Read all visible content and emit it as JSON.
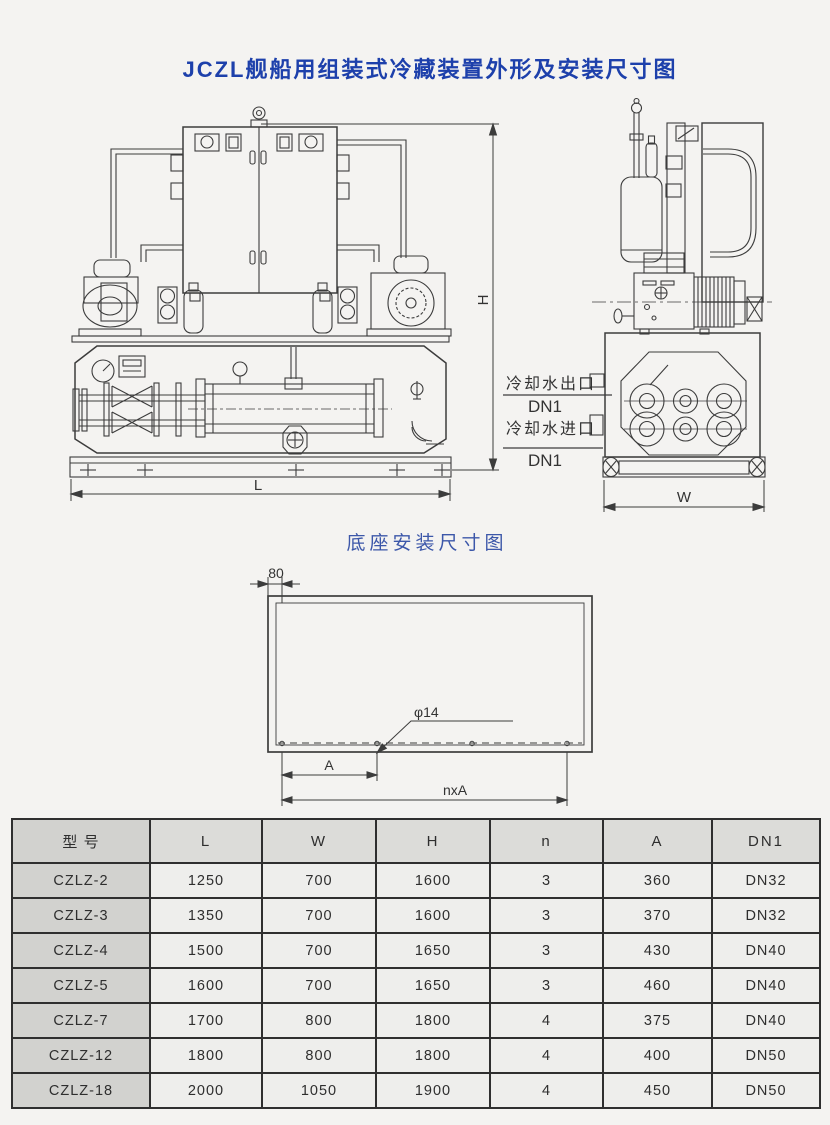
{
  "page": {
    "title": "JCZL舰船用组装式冷藏装置外形及安装尺寸图",
    "subtitle": "底座安装尺寸图"
  },
  "drawing": {
    "dims": {
      "height_label": "H",
      "length_label": "L",
      "width_label": "W"
    },
    "cooling": {
      "outlet_label": "冷却水出口",
      "outlet_dn": "DN1",
      "inlet_label": "冷却水进口",
      "inlet_dn": "DN1"
    },
    "base": {
      "edge_offset": "80",
      "hole_diameter": "φ14",
      "pitch_label": "A",
      "total_label": "nxA"
    }
  },
  "table": {
    "headers": [
      "型 号",
      "L",
      "W",
      "H",
      "n",
      "A",
      "DN1"
    ],
    "rows": [
      [
        "CZLZ-2",
        "1250",
        "700",
        "1600",
        "3",
        "360",
        "DN32"
      ],
      [
        "CZLZ-3",
        "1350",
        "700",
        "1600",
        "3",
        "370",
        "DN32"
      ],
      [
        "CZLZ-4",
        "1500",
        "700",
        "1650",
        "3",
        "430",
        "DN40"
      ],
      [
        "CZLZ-5",
        "1600",
        "700",
        "1650",
        "3",
        "460",
        "DN40"
      ],
      [
        "CZLZ-7",
        "1700",
        "800",
        "1800",
        "4",
        "375",
        "DN40"
      ],
      [
        "CZLZ-12",
        "1800",
        "800",
        "1800",
        "4",
        "400",
        "DN50"
      ],
      [
        "CZLZ-18",
        "2000",
        "1050",
        "1900",
        "4",
        "450",
        "DN50"
      ]
    ]
  },
  "colors": {
    "title_blue": "#1d40ab",
    "subtitle_blue": "#3c57a9",
    "line": "#3c3c3c",
    "table_header_bg": "#dcdcd9",
    "model_col_bg": "#d2d2cf"
  }
}
